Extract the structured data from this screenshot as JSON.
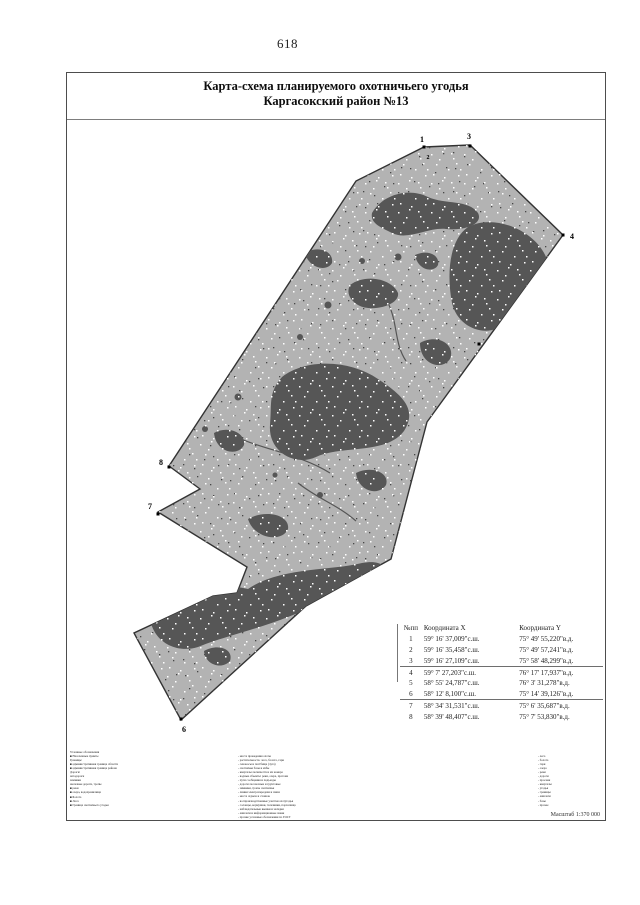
{
  "page_number": "618",
  "title": {
    "line1": "Карта-схема планируемого охотничьего угодья",
    "line2": "Каргасокский район №13"
  },
  "map": {
    "labels": {
      "p1": "1",
      "p2": "2",
      "p3": "3",
      "p4": "4",
      "p6": "6",
      "p7": "7",
      "p8": "8"
    },
    "land_color": "#b3b3b3",
    "forest_color": "#565656",
    "outline_color": "#333333"
  },
  "table": {
    "headers": [
      "№пп",
      "Координата X",
      "Координата Y"
    ],
    "rows": [
      [
        "1",
        "59° 16' 37,009\"с.ш.",
        "75° 49' 55,220\"в.д."
      ],
      [
        "2",
        "59° 16' 35,458\"с.ш.",
        "75° 49' 57,241\"в.д."
      ],
      [
        "3",
        "59° 16' 27,109\"с.ш.",
        "75° 58' 48,299\"в.д."
      ],
      [
        "4",
        "59° 7' 27,203\"с.ш.",
        "76° 17' 17,937\"в.д."
      ],
      [
        "5",
        "58° 55' 24,787\"с.ш.",
        "76° 3' 31,278\"в.д."
      ],
      [
        "6",
        "58° 12' 8,100\"с.ш.",
        "75° 14' 39,126\"в.д."
      ],
      [
        "7",
        "58° 34' 31,531\"с.ш.",
        "75° 6' 35,687\"в.д."
      ],
      [
        "8",
        "58° 39' 48,407\"с.ш.",
        "75° 7' 53,830\"в.д."
      ]
    ]
  },
  "legend": {
    "col1": [
      "Условные обозначения",
      "■ Населенные пункты",
      "Границы:",
      "■ административная граница области",
      "■ административная граница района",
      "Дороги:",
      "автодороги",
      "зимники",
      "железные дороги, тропы",
      "■ реки",
      "■ озера, водохранилища",
      "■ Болота",
      "■ Леса",
      "■ Граница охотничьего угодья"
    ],
    "col2": [
      "- места проведения охоты",
      "- растительность: леса, болота, гари",
      "- сенокосы и пастбища (луга)",
      "- охотничьи базы и избы",
      "- кварталы лесничеств и их номера",
      "- водные объекты: реки, озера, протоки",
      "- пути сообщения и подъезды",
      "- дороги лесовозные и грунтовые",
      "- зимники, тропы охотничьи",
      "- линии электропередачи и связи",
      "- места отдыха и стоянок",
      "- воспроизводственные участки охотугодья",
      "- солонцы, кормушки, галечники, порхалища",
      "- наблюдательные вышки и засидки",
      "- аншлаги и информационные знаки",
      "- прочие условные обозначения по ГОСТ"
    ],
    "col3": [
      "- леса",
      "- болота",
      "- гари",
      "- озера",
      "- реки",
      "- дороги",
      "- просеки",
      "- кварталы",
      "- угодья",
      "- границы",
      "- аншлаги",
      "- базы",
      "- прочее"
    ]
  },
  "scale_label": "Масштаб 1:370 000"
}
